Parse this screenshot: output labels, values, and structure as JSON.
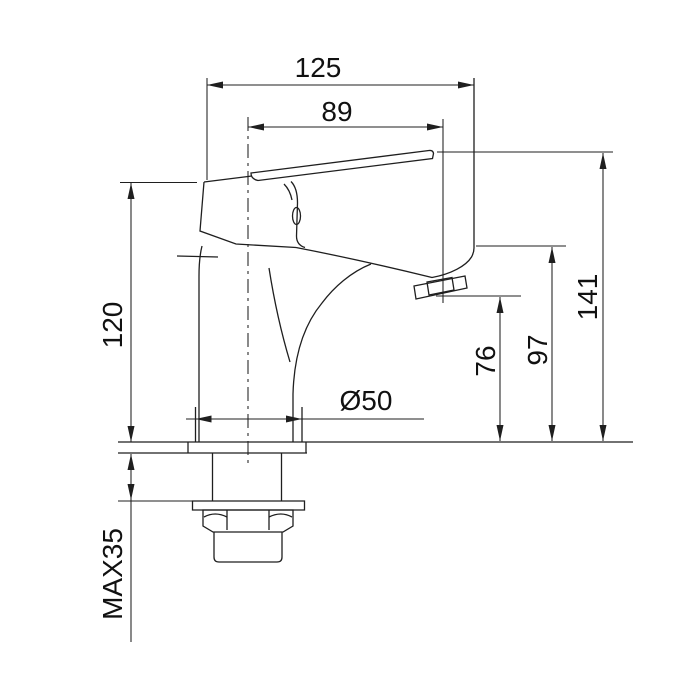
{
  "drawing": {
    "type": "technical-dimension-drawing",
    "subject": "single-lever basin tap side view",
    "background_color": "#ffffff",
    "line_color": "#1f1f1f",
    "text_color": "#111111",
    "labels": {
      "overall_projection": "125",
      "spout_reach": "89",
      "body_height": "120",
      "overall_height": "141",
      "spout_underside_height": "97",
      "outlet_height": "76",
      "base_diameter": "Ø50",
      "max_mounting_thickness": "MAX35"
    }
  }
}
